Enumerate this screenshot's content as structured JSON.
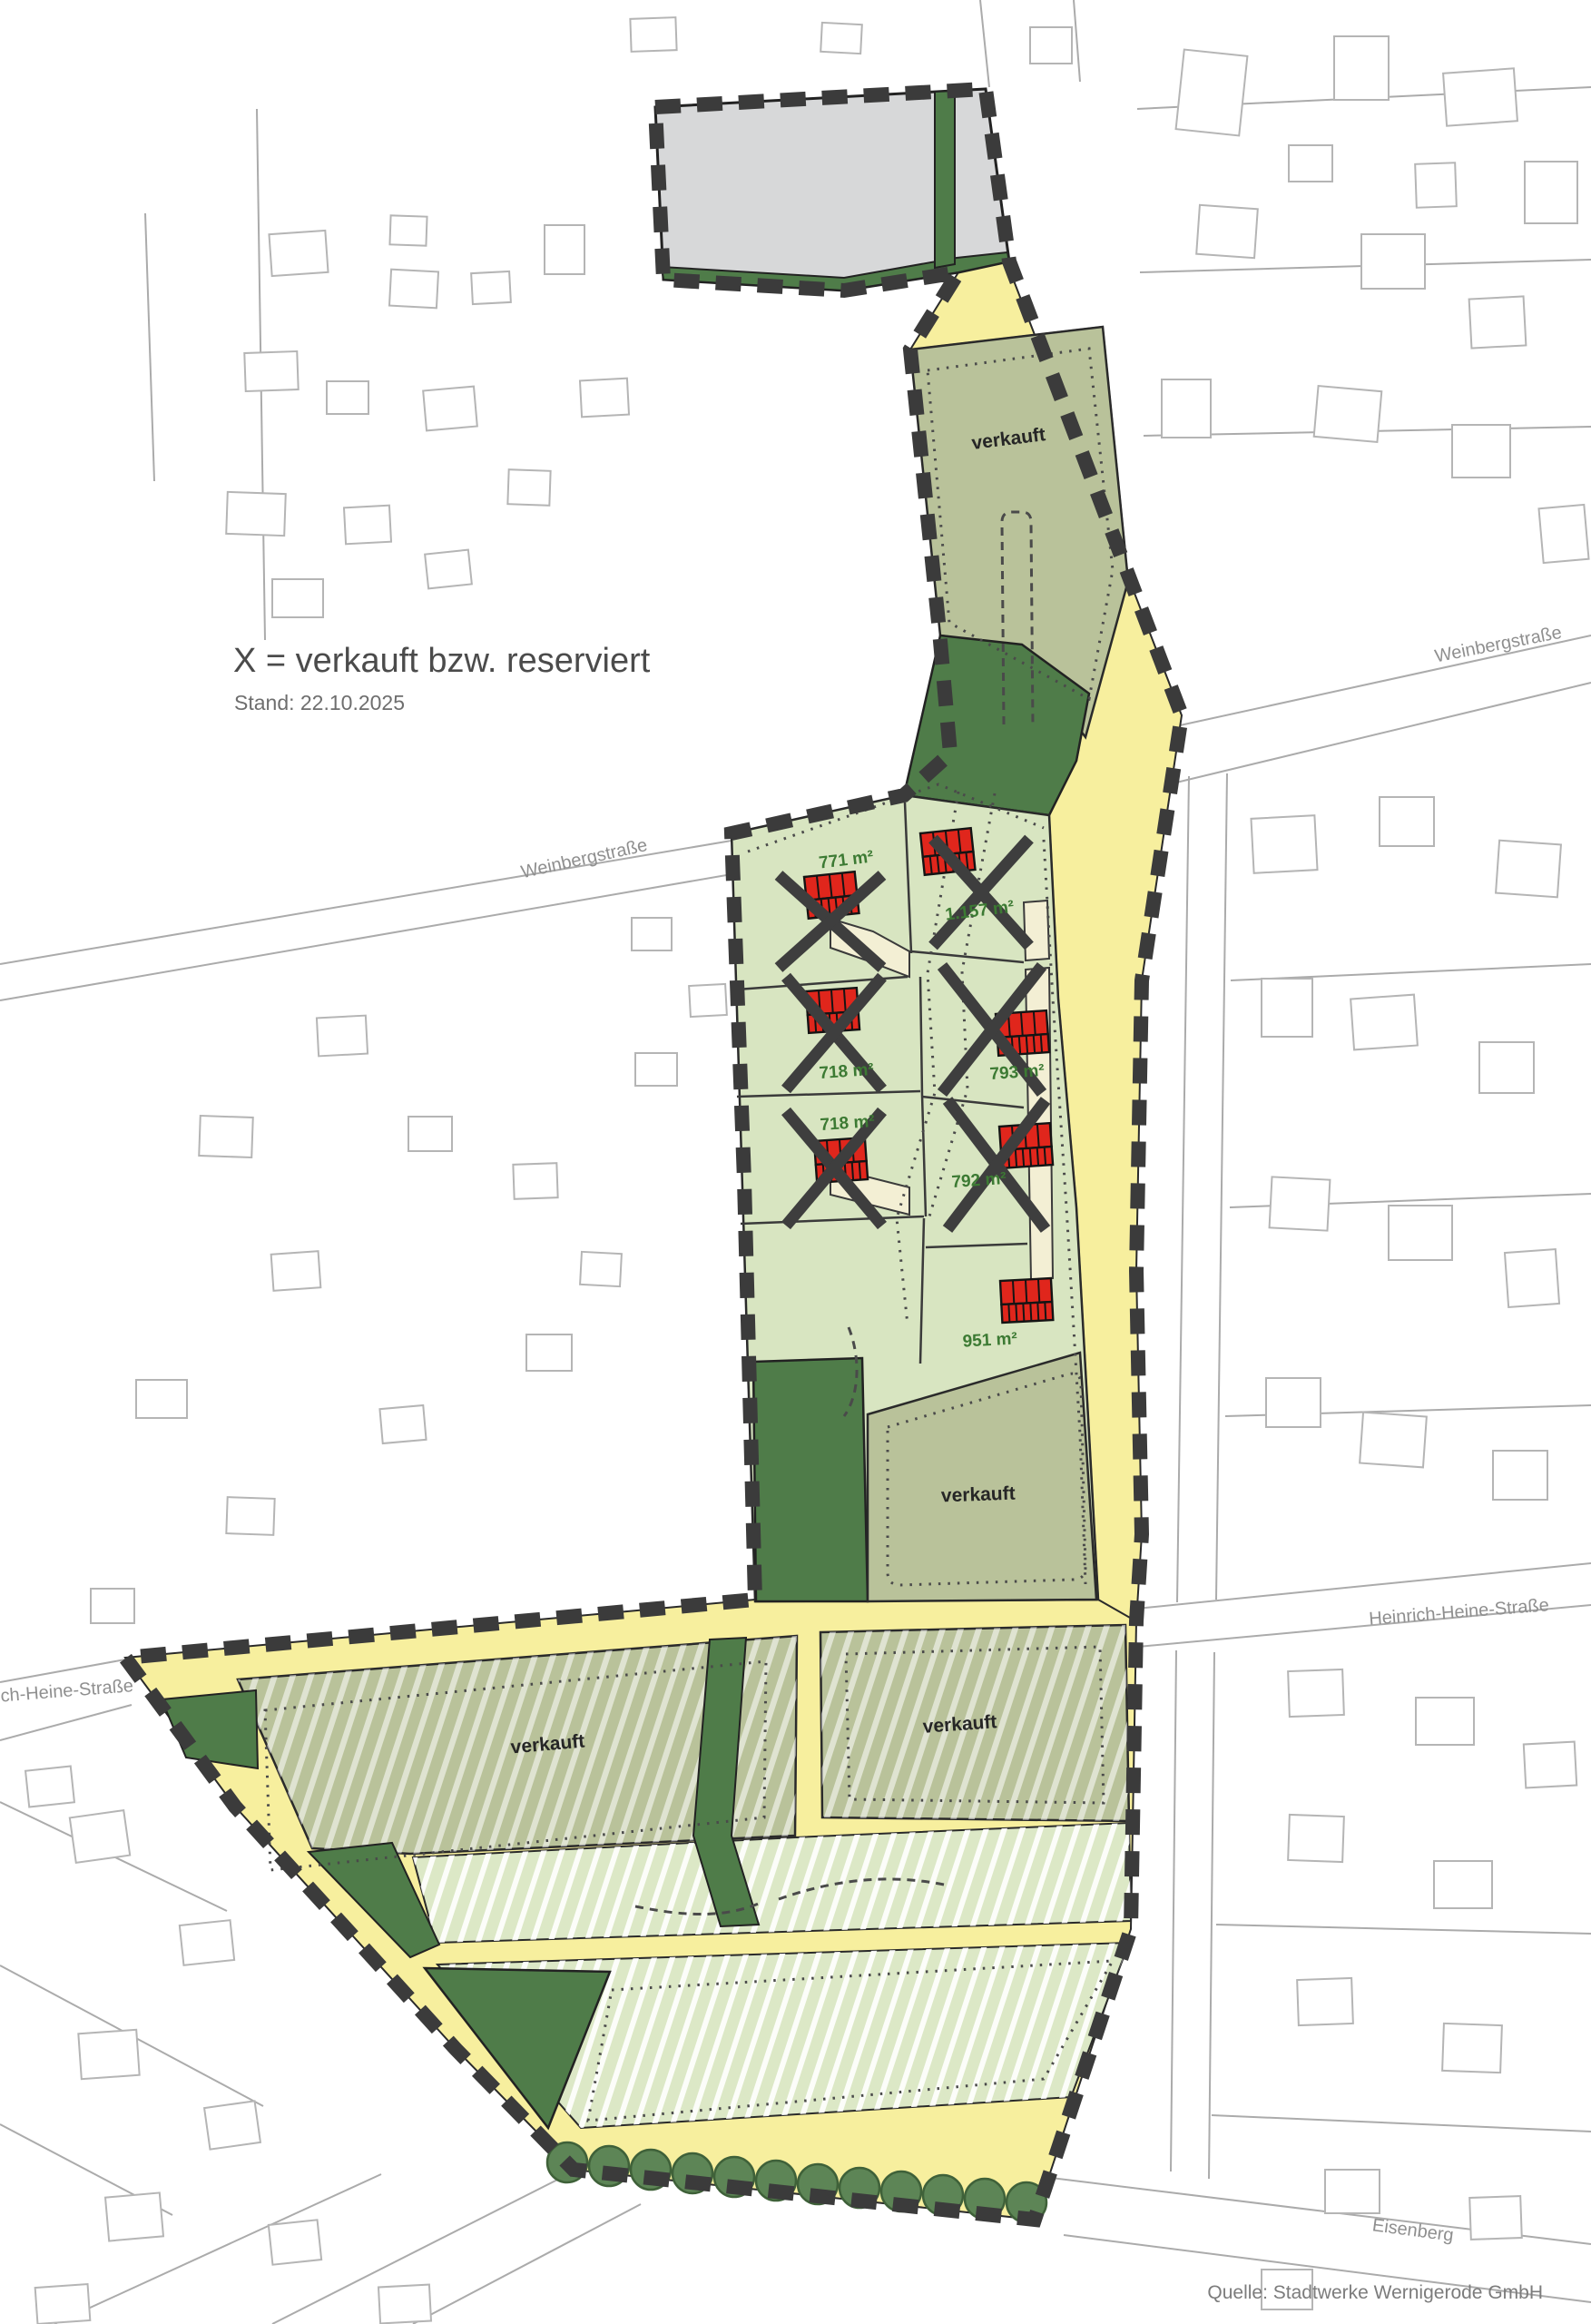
{
  "legend": {
    "title": "X = verkauft bzw. reserviert",
    "status_date": "Stand: 22.10.2025"
  },
  "source_note": "Quelle: Stadtwerke Wernigerode GmbH",
  "streets": {
    "weinbergstrasse_left": "Weinbergstraße",
    "weinbergstrasse_right": "Weinbergstraße",
    "heinrich_heine_left": "ich-Heine-Straße",
    "heinrich_heine_right": "Heinrich-Heine-Straße",
    "eisenberg": "Eisenberg"
  },
  "plots": [
    {
      "size": "771 m²",
      "crossed": true
    },
    {
      "size": "1.157 m²",
      "crossed": true
    },
    {
      "size": "718 m²",
      "crossed": true
    },
    {
      "size": "793 m²",
      "crossed": true
    },
    {
      "size": "718 m²",
      "crossed": true
    },
    {
      "size": "792 m²",
      "crossed": true
    },
    {
      "size": "951 m²",
      "crossed": false
    }
  ],
  "sold_areas": [
    {
      "label": "verkauft"
    },
    {
      "label": "verkauft"
    },
    {
      "label": "verkauft"
    },
    {
      "label": "verkauft"
    }
  ],
  "colors": {
    "road_yellow": "#f7ef9e",
    "plot_light_green": "#d8e5c1",
    "plot_olive": "#b9c29a",
    "green_space": "#4f7c49",
    "house_red": "#e0261c",
    "boundary_dark": "#3b3b3b",
    "survey_gray": "#b5b5b5",
    "existing_gray": "#d7d8d9",
    "driveway_beige": "#f3efd4"
  }
}
